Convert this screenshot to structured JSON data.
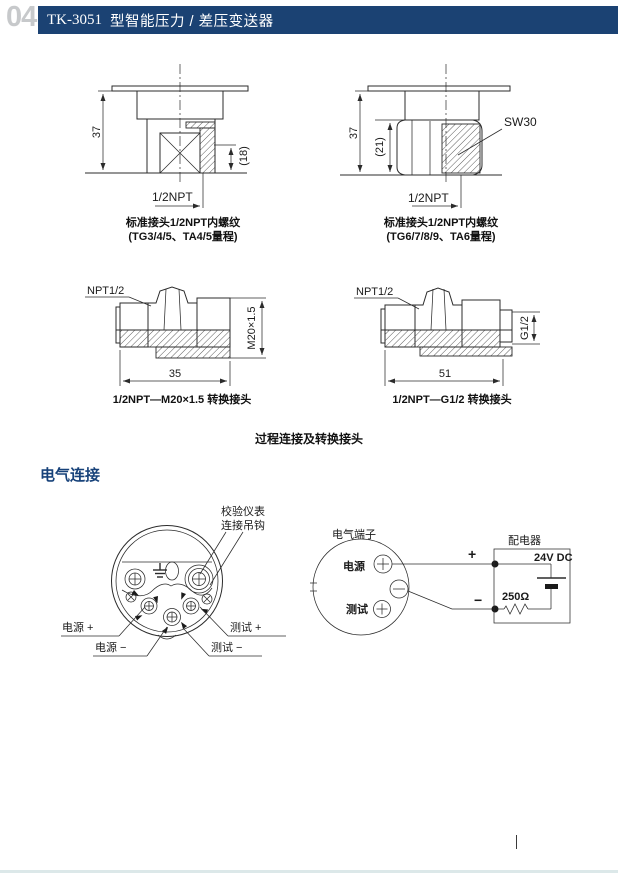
{
  "page": {
    "number": "04",
    "title_model": "TK-3051",
    "title_rest": "型智能压力 / 差压变送器",
    "colors": {
      "header_bar": "#1b4273",
      "page_number": "#c7c9cb",
      "heading_text": "#17427a",
      "line_art": "#2b2b2b",
      "footer_strip": "#dce8e9"
    }
  },
  "process": {
    "tl": {
      "dim_h": "37",
      "dim_d": "(18)",
      "thread": "1/2NPT",
      "cap1": "标准接头1/2NPT内螺纹",
      "cap2": "(TG3/4/5、TA4/5量程)"
    },
    "tr": {
      "dim_h": "37",
      "dim_d": "(21)",
      "wrench": "SW30",
      "thread": "1/2NPT",
      "cap1": "标准接头1/2NPT内螺纹",
      "cap2": "(TG6/7/8/9、TA6量程)"
    },
    "ml": {
      "thread": "NPT1/2",
      "side_dim": "M20×1.5",
      "len_dim": "35",
      "cap": "1/2NPT—M20×1.5 转换接头"
    },
    "mr": {
      "thread": "NPT1/2",
      "side_dim": "G1/2",
      "len_dim": "51",
      "cap": "1/2NPT—G1/2 转换接头"
    },
    "footer_caption": "过程连接及转换接头"
  },
  "electrical": {
    "heading": "电气连接",
    "terminal": {
      "hook1": "校验仪表",
      "hook2": "连接吊钩",
      "p_plus": "电源 +",
      "p_minus": "电源 −",
      "t_plus": "测试 +",
      "t_minus": "测试 −"
    },
    "wiring": {
      "label": "电气端子",
      "power": "电源",
      "test": "测试",
      "plus": "+",
      "minus": "−",
      "box": "配电器",
      "volt": "24V DC",
      "res": "250Ω"
    }
  }
}
